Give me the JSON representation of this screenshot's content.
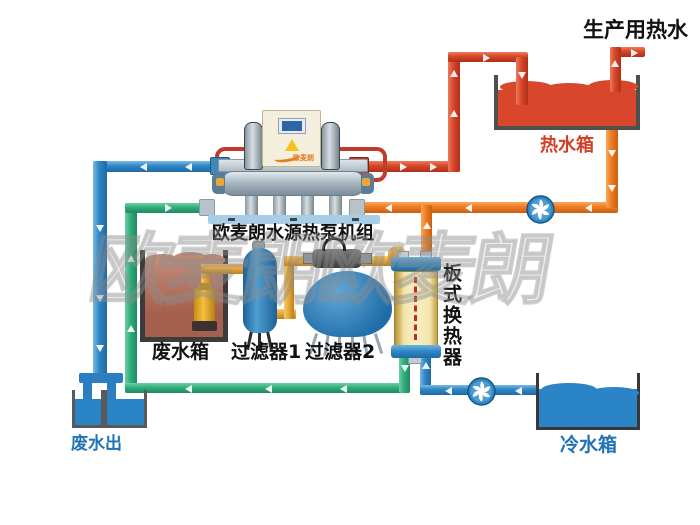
{
  "diagram": {
    "type": "water-source-heat-pump-hot-water-system-schematic",
    "top_label": "生产用热水",
    "hot_water_tank": {
      "label": "热水箱",
      "water_color": "#d8472b"
    },
    "heat_pump": {
      "label": "欧麦朗水源热泵机组",
      "logo": "欧麦朗"
    },
    "waste_water_tank": {
      "label": "废水箱",
      "water_color": "#b26a58"
    },
    "filter1": {
      "label": "过滤器1"
    },
    "filter2": {
      "label": "过滤器2"
    },
    "plate_heat_exchanger": {
      "label": "板式换热器"
    },
    "waste_water_out": {
      "label": "废水出"
    },
    "cold_water_tank": {
      "label": "冷水箱",
      "water_color": "#2b84c6"
    },
    "watermark": "欧麦朗欧麦朗",
    "pipe_colors": {
      "hot_supply_red": "#d8452a",
      "hot_return_orange": "#ef7b22",
      "cold_blue": "#2e86c4",
      "source_green": "#2fae7d",
      "waste_gold": "#e9a838"
    }
  }
}
